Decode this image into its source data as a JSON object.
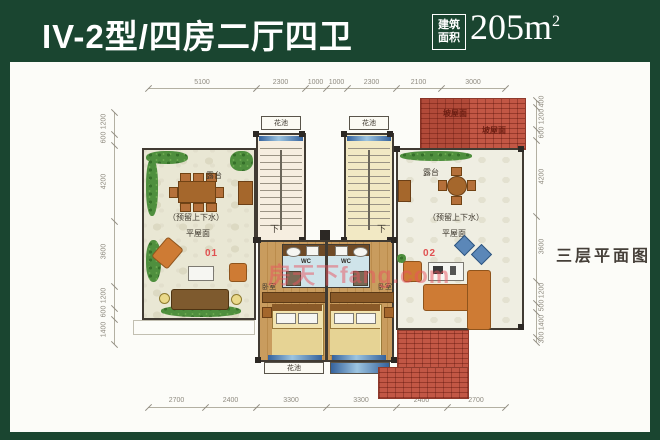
{
  "header": {
    "title": "IV-2型/四房二厅四卫",
    "area_label_top": "建筑",
    "area_label_bottom": "面积",
    "area_value": "205m",
    "area_exponent": "2"
  },
  "side_note": "三层平面图",
  "watermark": "房天下fang.com",
  "units": {
    "left": {
      "number": "01",
      "terrace": "露台",
      "reserved": "（预留上下水）",
      "flat_roof": "平屋面",
      "bedroom": "卧室",
      "wc": "WC",
      "stair_down": "下",
      "flower_box": "花池",
      "flower_bed": "花池"
    },
    "right": {
      "number": "02",
      "terrace": "露台",
      "reserved": "（预留上下水）",
      "flat_roof": "平屋面",
      "bedroom": "卧室",
      "wc": "WC",
      "stair_down": "下",
      "flower_box": "花池"
    }
  },
  "roof": {
    "label1": "坡屋面",
    "label2": "坡屋面"
  },
  "dims": {
    "top": [
      "5100",
      "2300",
      "1000",
      "1000",
      "2300",
      "2100",
      "3000"
    ],
    "bottom": [
      "2700",
      "2400",
      "3300",
      "3300",
      "2400",
      "2700"
    ],
    "left": [
      "1200",
      "600",
      "4200",
      "3600",
      "1200",
      "600",
      "1400"
    ],
    "right": [
      "400",
      "1200",
      "600",
      "4200",
      "3600",
      "1200",
      "500",
      "1400",
      "300"
    ]
  },
  "colors": {
    "frame_green": "#1a4530",
    "roof_red": "#c25745",
    "unit_number_red": "#e05050",
    "watermark_pink": "#e8555f"
  }
}
